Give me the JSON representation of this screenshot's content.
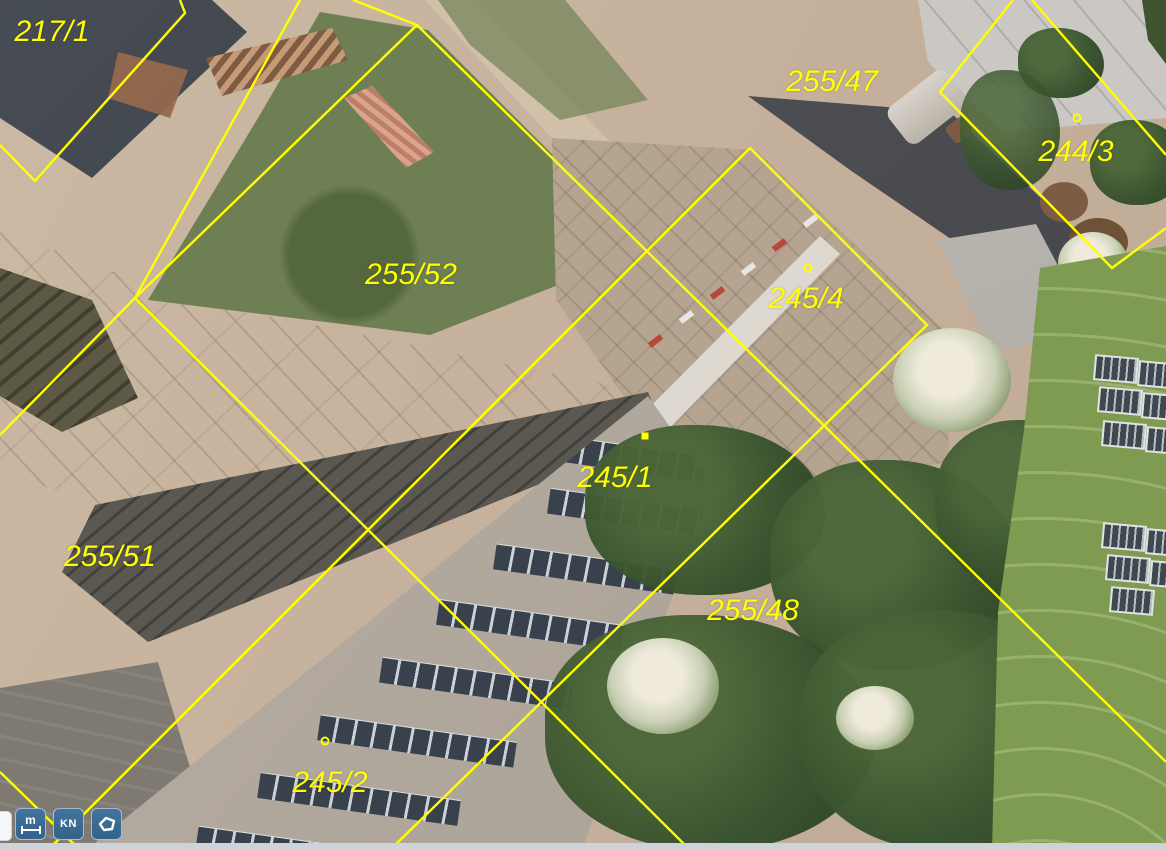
{
  "map": {
    "description": "Aerial cadastral map with yellow parcel boundaries",
    "line_color": "#ffff00",
    "label_color": "#ffff00",
    "parcels": [
      {
        "id": "217/1",
        "label_x": 52,
        "label_y": 32
      },
      {
        "id": "255/47",
        "label_x": 832,
        "label_y": 82
      },
      {
        "id": "244/3",
        "label_x": 1076,
        "label_y": 152
      },
      {
        "id": "255/52",
        "label_x": 411,
        "label_y": 275
      },
      {
        "id": "245/4",
        "label_x": 806,
        "label_y": 299
      },
      {
        "id": "245/1",
        "label_x": 615,
        "label_y": 478
      },
      {
        "id": "255/51",
        "label_x": 110,
        "label_y": 557
      },
      {
        "id": "255/48",
        "label_x": 753,
        "label_y": 611
      },
      {
        "id": "245/2",
        "label_x": 330,
        "label_y": 783
      }
    ],
    "markers": [
      {
        "x": 808,
        "y": 268,
        "shape": "circle"
      },
      {
        "x": 645,
        "y": 436,
        "shape": "square"
      },
      {
        "x": 325,
        "y": 741,
        "shape": "circle"
      },
      {
        "x": 1077,
        "y": 118,
        "shape": "circle"
      }
    ],
    "boundary_lines": [
      [
        [
          180,
          0
        ],
        [
          185,
          13
        ],
        [
          35,
          181
        ],
        [
          0,
          145
        ]
      ],
      [
        [
          300,
          0
        ],
        [
          135,
          298
        ],
        [
          0,
          435
        ]
      ],
      [
        [
          135,
          298
        ],
        [
          690,
          850
        ]
      ],
      [
        [
          353,
          0
        ],
        [
          417,
          25
        ],
        [
          1166,
          762
        ]
      ],
      [
        [
          417,
          25
        ],
        [
          135,
          298
        ]
      ],
      [
        [
          750,
          148
        ],
        [
          48,
          850
        ]
      ],
      [
        [
          750,
          148
        ],
        [
          927,
          325
        ],
        [
          390,
          850
        ]
      ],
      [
        [
          0,
          772
        ],
        [
          80,
          850
        ]
      ],
      [
        [
          1013,
          0
        ],
        [
          940,
          92
        ],
        [
          1112,
          268
        ],
        [
          1166,
          228
        ]
      ],
      [
        [
          1032,
          0
        ],
        [
          1166,
          155
        ]
      ]
    ]
  },
  "toolbar": {
    "buttons": [
      {
        "id": "measure",
        "label": "m"
      },
      {
        "id": "kn",
        "label": "KN"
      },
      {
        "id": "polygon-select",
        "label": ""
      }
    ]
  }
}
